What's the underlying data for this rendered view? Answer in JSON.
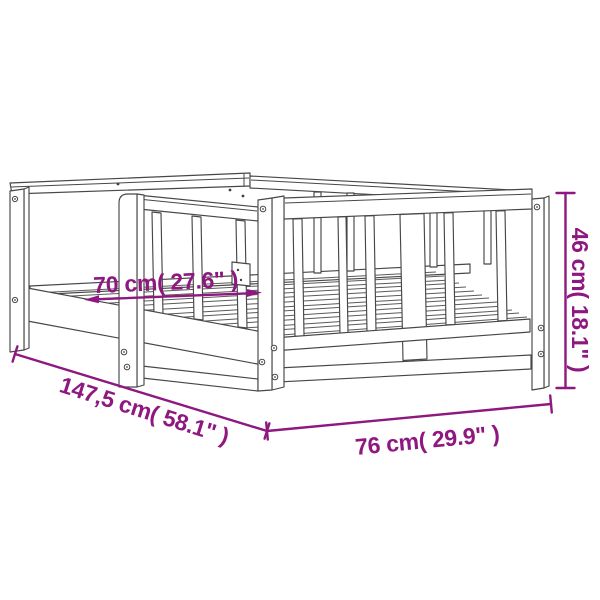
{
  "diagram": {
    "type": "product-dimension-diagram",
    "subject": "kids bed frame line drawing",
    "labels": {
      "inner_width": "70 cm( 27.6\" )",
      "length": "147,5 cm( 58.1\" )",
      "outer_width": "76 cm( 29.9\" )",
      "height": "46 cm( 18.1\" )"
    },
    "colors": {
      "annotation": "#8E187F",
      "line_art": "#474747",
      "background": "#ffffff"
    }
  }
}
